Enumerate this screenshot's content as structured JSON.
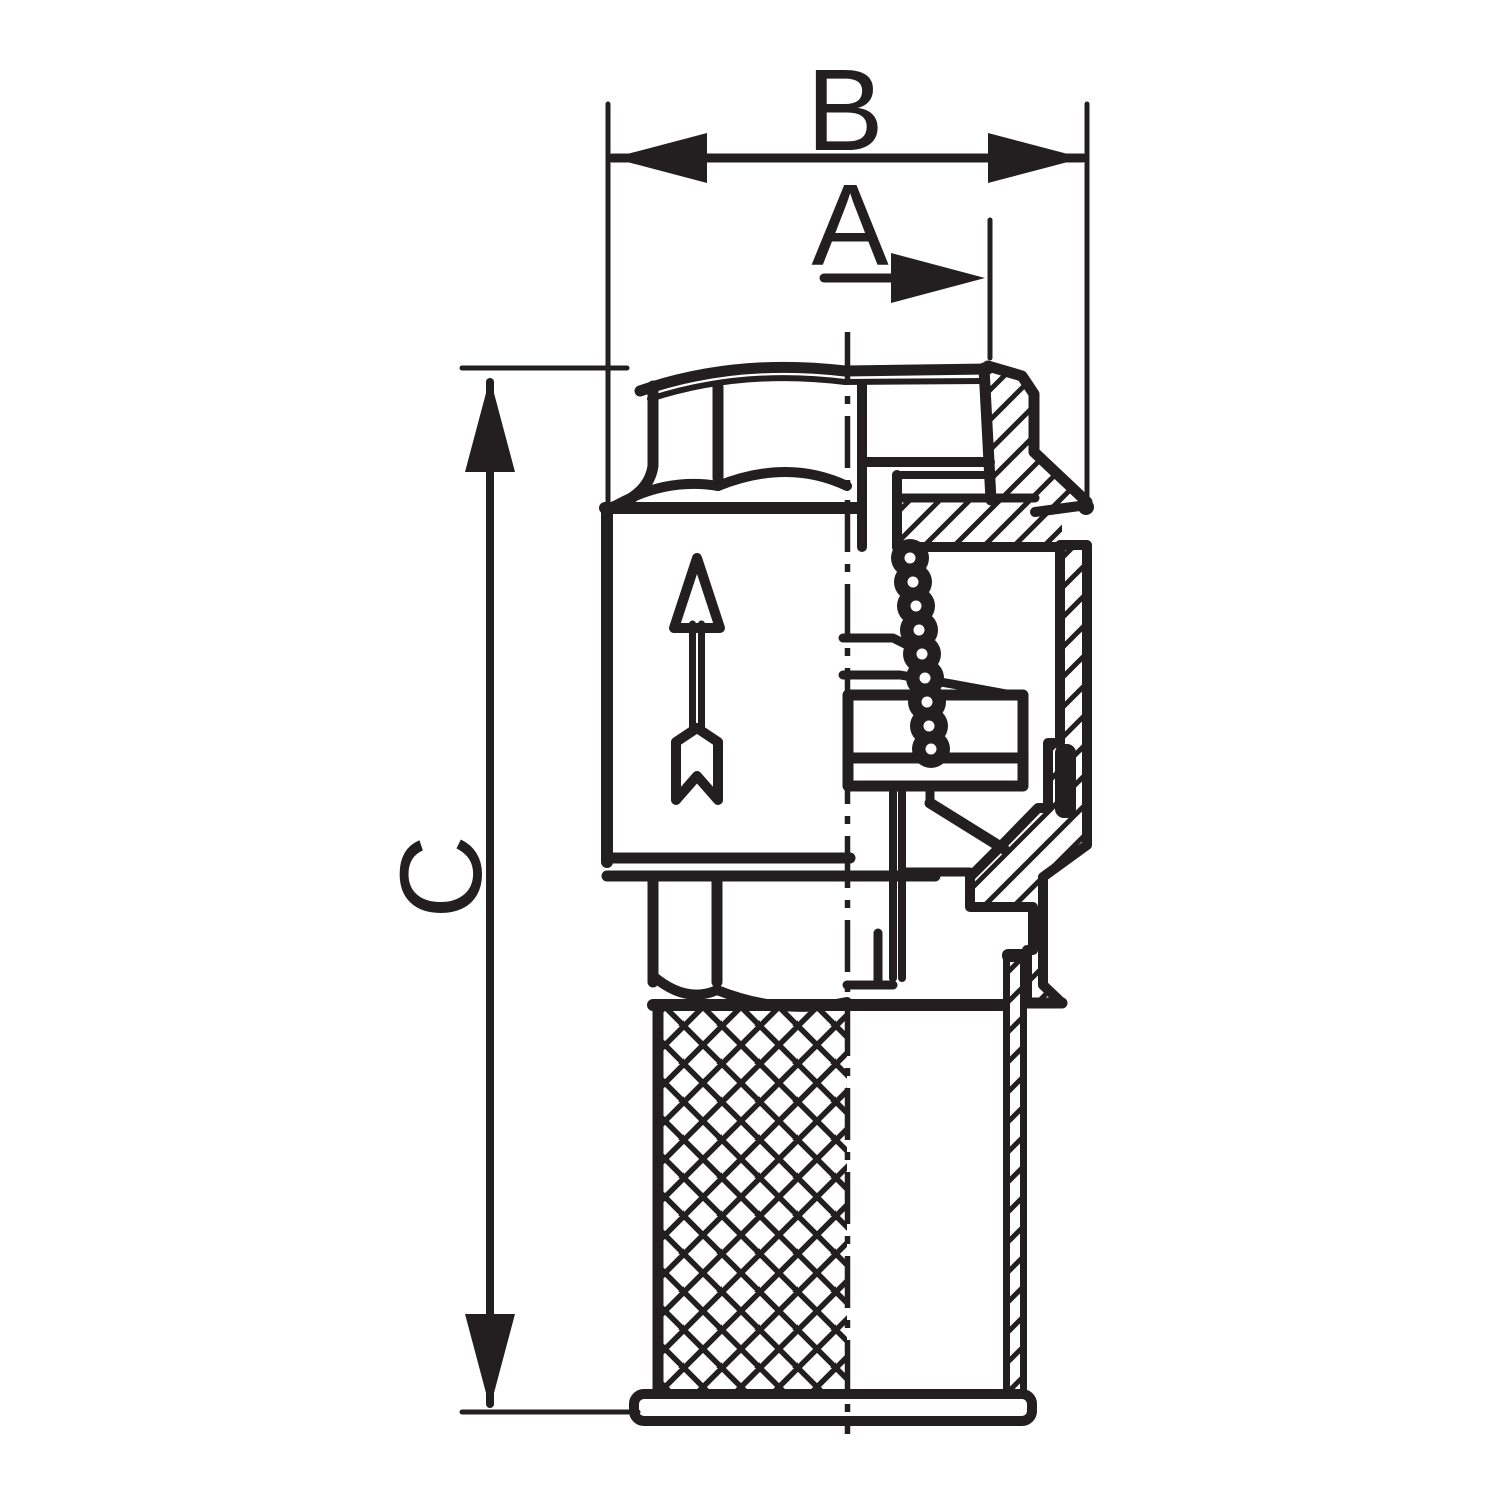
{
  "drawing": {
    "type": "technical-drawing",
    "subject": "check-valve-with-strainer-sectional-view",
    "line_color": "#231f20",
    "background_color": "#ffffff",
    "dimensions": [
      {
        "id": "B",
        "label": "B",
        "orientation": "horizontal"
      },
      {
        "id": "A",
        "label": "A",
        "orientation": "horizontal"
      },
      {
        "id": "C",
        "label": "C",
        "orientation": "vertical"
      }
    ],
    "symbols": [
      {
        "name": "flow-direction-arrow",
        "meaning": "flow direction upward"
      },
      {
        "name": "centerline",
        "style": "dash-dot"
      },
      {
        "name": "section-hatching",
        "style": "45-degree"
      },
      {
        "name": "strainer-mesh",
        "style": "cross-hatch"
      }
    ]
  }
}
